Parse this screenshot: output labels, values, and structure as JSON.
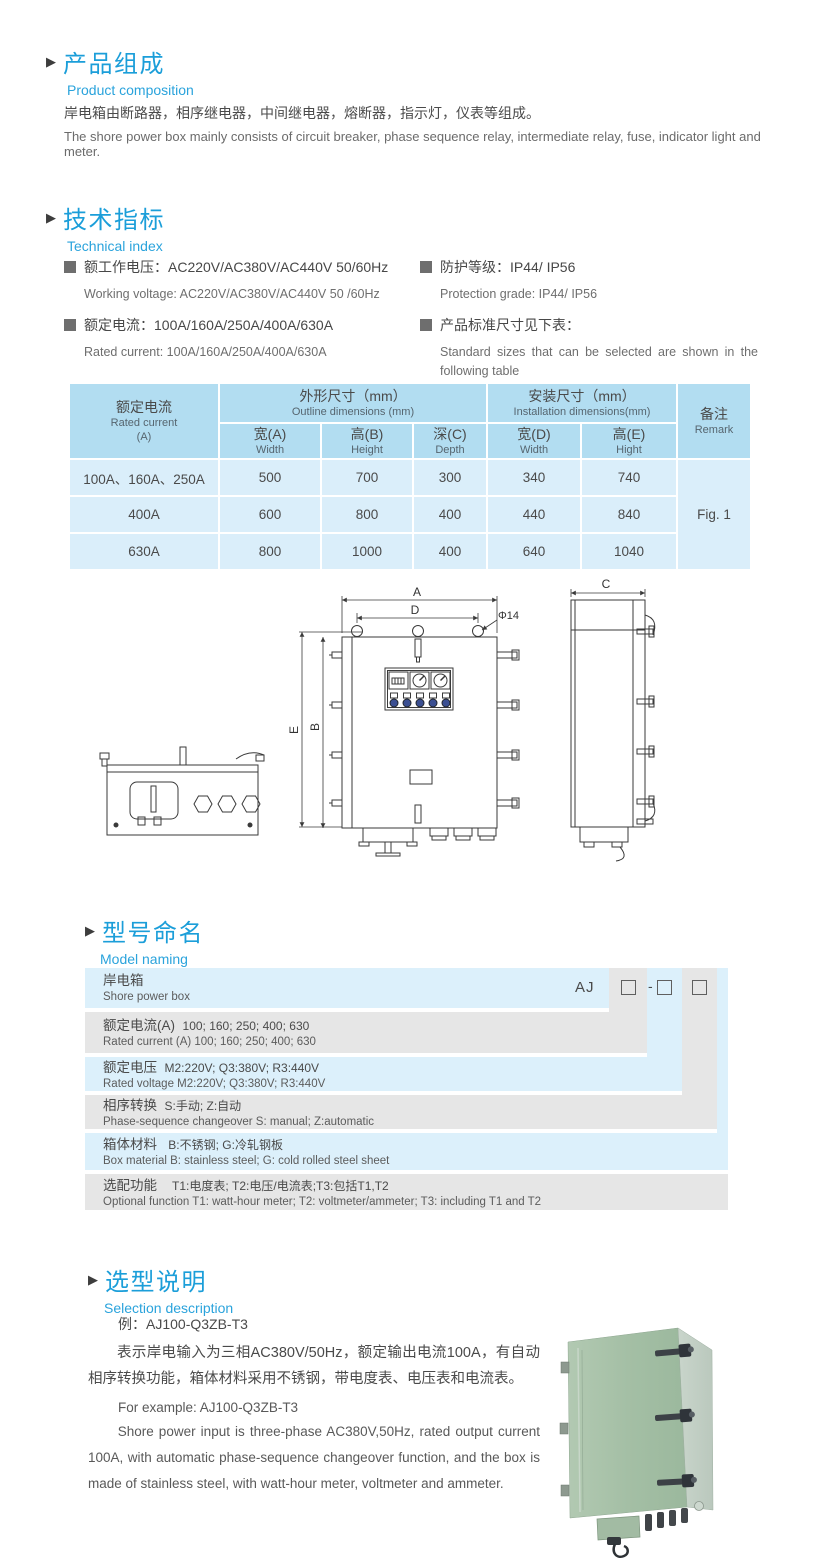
{
  "page": {
    "bg": "#ffffff",
    "accent": "#1b9ed9"
  },
  "composition": {
    "marker": "▶",
    "title_cn": "产品组成",
    "title_en": "Product  composition",
    "para_cn": "岸电箱由断路器，相序继电器，中间继电器，熔断器，指示灯，仪表等组成。",
    "para_en": "The shore power box mainly consists of circuit breaker, phase sequence relay, intermediate relay, fuse, indicator light and meter."
  },
  "technical": {
    "marker": "▶",
    "title_cn": "技术指标",
    "title_en": "Technical index",
    "specs_left": [
      {
        "cn": "额工作电压：AC220V/AC380V/AC440V  50/60Hz",
        "en": "Working voltage: AC220V/AC380V/AC440V 50 /60Hz"
      },
      {
        "cn": "额定电流：100A/160A/250A/400A/630A",
        "en": "Rated current: 100A/160A/250A/400A/630A"
      }
    ],
    "specs_right": [
      {
        "cn": "防护等级：IP44/ IP56",
        "en": "Protection grade: IP44/ IP56"
      },
      {
        "cn": "产品标准尺寸见下表：",
        "en": "Standard sizes that can be selected are shown in the following table"
      }
    ]
  },
  "dim_table": {
    "col_current_cn": "额定电流",
    "col_current_en": "Rated current",
    "col_current_unit": "(A)",
    "outline_cn": "外形尺寸（mm）",
    "outline_en": "Outline dimensions (mm)",
    "install_cn": "安装尺寸（mm）",
    "install_en": "Installation dimensions(mm)",
    "remark_cn": "备注",
    "remark_en": "Remark",
    "sub_headers": [
      {
        "cn": "宽(A)",
        "en": "Width"
      },
      {
        "cn": "高(B)",
        "en": "Height"
      },
      {
        "cn": "深(C)",
        "en": "Depth"
      },
      {
        "cn": "宽(D)",
        "en": "Width"
      },
      {
        "cn": "高(E)",
        "en": "Hight"
      }
    ],
    "rows": [
      {
        "label": "100A、160A、250A",
        "values": [
          "500",
          "700",
          "300",
          "340",
          "740"
        ]
      },
      {
        "label": "400A",
        "values": [
          "600",
          "800",
          "400",
          "440",
          "840"
        ]
      },
      {
        "label": "630A",
        "values": [
          "800",
          "1000",
          "400",
          "640",
          "1040"
        ]
      }
    ],
    "remark_value": "Fig. 1"
  },
  "drawing": {
    "labels": {
      "a": "A",
      "d": "D",
      "phi": "Φ14",
      "e": "E",
      "b": "B",
      "c": "C"
    }
  },
  "model_naming": {
    "marker": "▶",
    "title_cn": "型号命名",
    "title_en": "Model naming",
    "prefix": "AJ",
    "minus": "-",
    "rows": [
      {
        "cn": "岸电箱",
        "en": "Shore power box"
      },
      {
        "label_cn": "额定电流(A)",
        "value_cn": "100; 160; 250; 400; 630",
        "en": "Rated current (A) 100; 160; 250; 400; 630"
      },
      {
        "label_cn": "额定电压",
        "value_cn": "M2:220V;  Q3:380V;  R3:440V",
        "en": "Rated voltage  M2:220V;  Q3:380V;  R3:440V"
      },
      {
        "label_cn": "相序转换",
        "value_cn": "S:手动; Z:自动",
        "en": "Phase-sequence changeover  S: manual;  Z:automatic"
      },
      {
        "label_cn": "箱体材料",
        "value_cn": "B:不锈钢;  G:冷轧钢板",
        "en": "Box material   B: stainless steel; G: cold rolled steel sheet"
      },
      {
        "label_cn": "选配功能",
        "value_cn": "T1:电度表;  T2:电压/电流表;T3:包括T1,T2",
        "en": "Optional function  T1: watt-hour meter; T2: voltmeter/ammeter; T3: including T1 and T2"
      }
    ]
  },
  "selection": {
    "marker": "▶",
    "title_cn": "选型说明",
    "title_en": "Selection description",
    "example_cn": "例：AJ100-Q3ZB-T3",
    "desc_cn": "表示岸电输入为三相AC380V/50Hz，额定输出电流100A，有自动相序转换功能，箱体材料采用不锈钢，带电度表、电压表和电流表。",
    "example_en": "For example: AJ100-Q3ZB-T3",
    "desc_en": "Shore power input is three-phase AC380V,50Hz, rated output current 100A, with automatic phase-sequence changeover function, and the box is made of stainless steel, with watt-hour meter, voltmeter and ammeter."
  }
}
